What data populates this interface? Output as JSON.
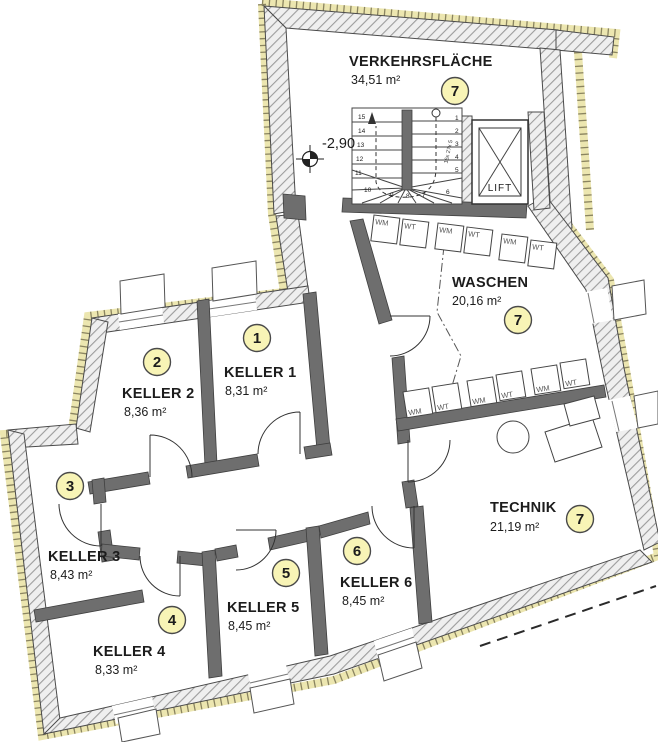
{
  "title": "Kellergeschoss Grundriss",
  "colors": {
    "badge_fill": "#f8f4b6",
    "badge_stroke": "#4a4a4a",
    "wall_dark": "#6e6e6e",
    "insulation": "#ece6b0"
  },
  "level_marker": {
    "value": "-2,90"
  },
  "lift": {
    "label": "LIFT"
  },
  "stairs": {
    "note": "16x 27x 5",
    "left_steps": [
      "15",
      "14",
      "13",
      "12",
      "11"
    ],
    "right_steps": [
      "1",
      "2",
      "3",
      "4",
      "5"
    ],
    "fan_steps": [
      "6",
      "7",
      "8",
      "9",
      "10"
    ]
  },
  "rooms": [
    {
      "id": "verkehrsflaeche",
      "name": "VERKEHRSFLÄCHE",
      "area": "34,51 m²",
      "badge": "7"
    },
    {
      "id": "waschen",
      "name": "WASCHEN",
      "area": "20,16 m²",
      "badge": "7"
    },
    {
      "id": "technik",
      "name": "TECHNIK",
      "area": "21,19 m²",
      "badge": "7"
    },
    {
      "id": "keller1",
      "name": "KELLER 1",
      "area": "8,31 m²",
      "badge": "1"
    },
    {
      "id": "keller2",
      "name": "KELLER 2",
      "area": "8,36 m²",
      "badge": "2"
    },
    {
      "id": "keller3",
      "name": "KELLER 3",
      "area": "8,43 m²",
      "badge": "3"
    },
    {
      "id": "keller4",
      "name": "KELLER 4",
      "area": "8,33 m²",
      "badge": "4"
    },
    {
      "id": "keller5",
      "name": "KELLER 5",
      "area": "8,45 m²",
      "badge": "5"
    },
    {
      "id": "keller6",
      "name": "KELLER 6",
      "area": "8,45 m²",
      "badge": "6"
    }
  ],
  "appliances": {
    "top_row": [
      "WM",
      "WT",
      "WM",
      "WT",
      "WM",
      "WT"
    ],
    "bottom_row": [
      "WM",
      "WT",
      "WM",
      "WT",
      "WM",
      "WT"
    ]
  }
}
